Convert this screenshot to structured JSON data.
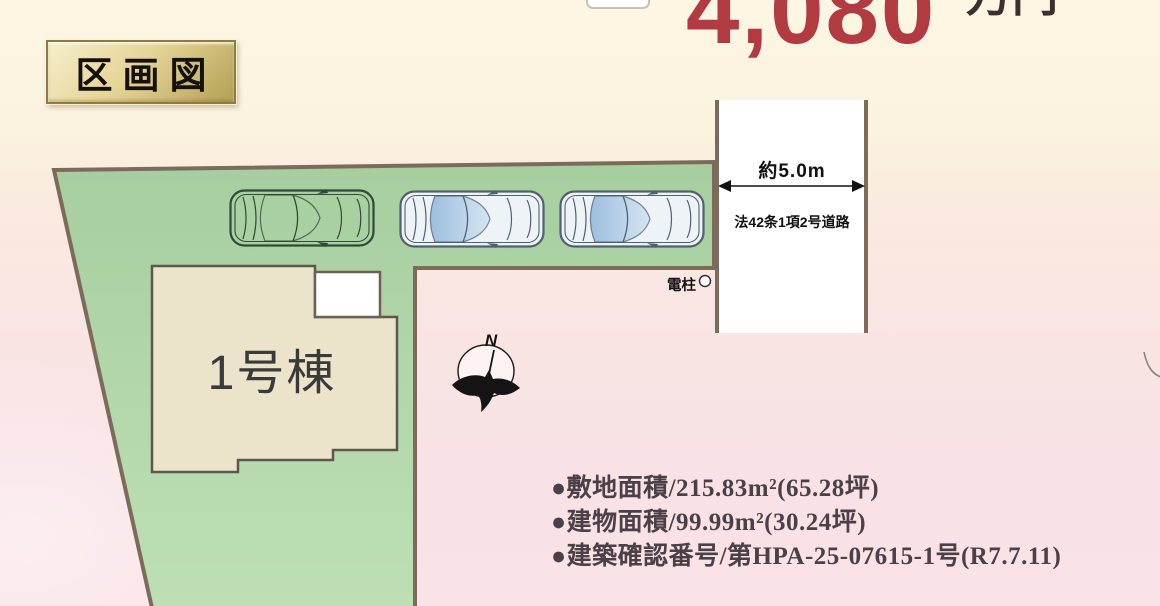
{
  "title_badge": {
    "label": "区画図"
  },
  "price_banner": {
    "amount": "4,080",
    "unit": "万円",
    "amount_color": "#b23a41",
    "unit_color": "#39312f"
  },
  "plan": {
    "building_label": "1号棟",
    "road_width_label": "約5.0m",
    "road_name_label": "法42条1項2号道路",
    "utility_pole_label": "電柱",
    "north_label": "N",
    "car_count": 3,
    "colors": {
      "land_fill": "#aed3a7",
      "land_border": "#7d6b5a",
      "house_fill": "#ece3cb",
      "house_border": "#5f574d",
      "road_fill": "#ffffff"
    }
  },
  "site_info": {
    "lines": [
      "●敷地面積/215.83m²(65.28坪)",
      "●建物面積/99.99m²(30.24坪)",
      "●建築確認番号/第HPA-25-07615-1号(R7.7.11)"
    ],
    "text_color": "#4b4047"
  }
}
